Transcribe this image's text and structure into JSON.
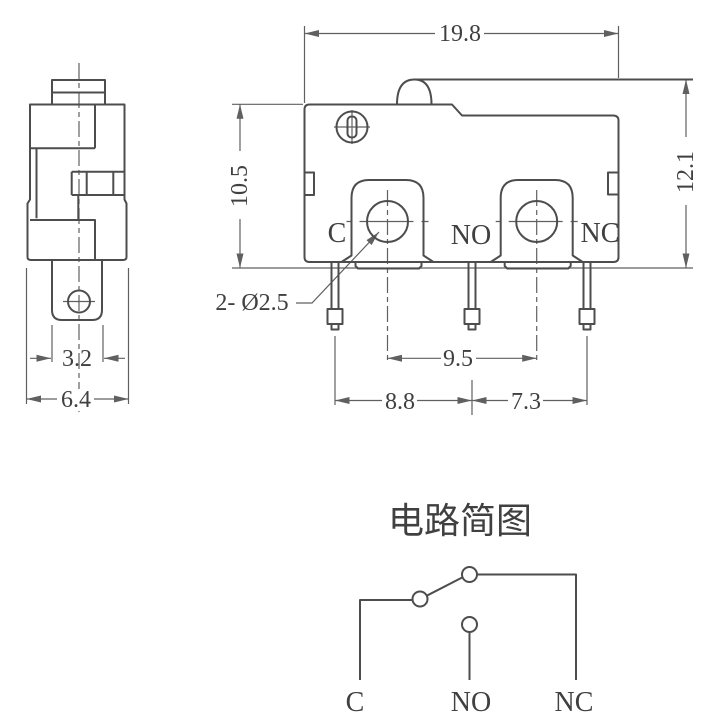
{
  "side_view": {
    "dim_tab_width": "3.2",
    "dim_body_width": "6.4"
  },
  "front_view": {
    "dim_width": "19.8",
    "dim_body_height": "10.5",
    "dim_total_height": "12.1",
    "dim_hole_spacing": "9.5",
    "dim_pitch_c_no": "8.8",
    "dim_pitch_no_nc": "7.3",
    "hole_callout": "2- Ø2.5",
    "terminal_c": "C",
    "terminal_no": "NO",
    "terminal_nc": "NC"
  },
  "circuit": {
    "title": "电路简图",
    "terminal_c": "C",
    "terminal_no": "NO",
    "terminal_nc": "NC"
  },
  "colors": {
    "part_line": "#4d4d4d",
    "dim_line": "#606060",
    "text": "#404040",
    "background": "#ffffff"
  }
}
